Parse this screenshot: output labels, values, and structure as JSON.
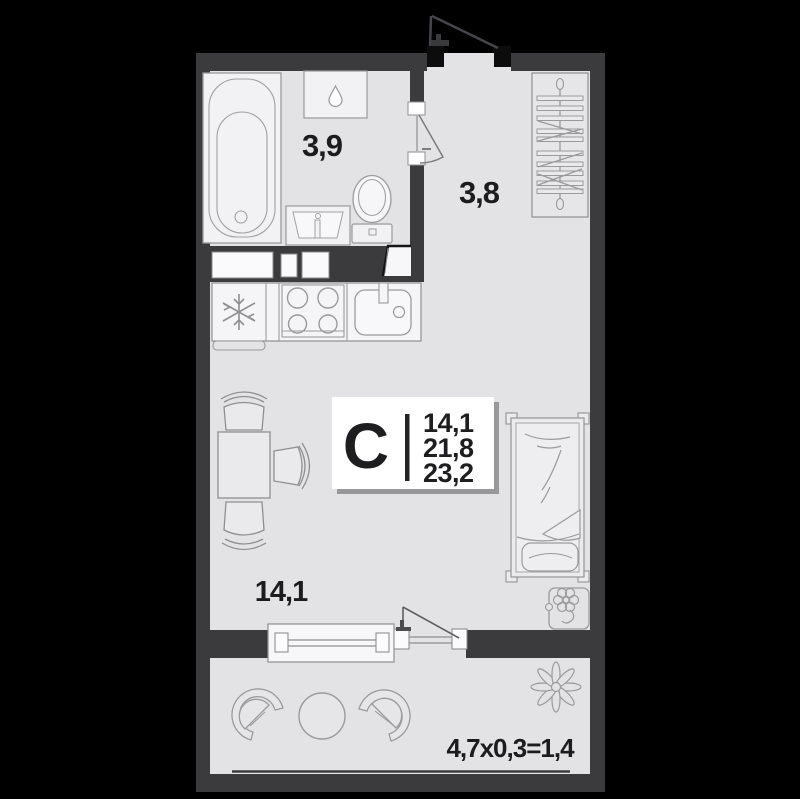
{
  "plan": {
    "type_card": {
      "letter": "С",
      "areas": [
        "14,1",
        "21,8",
        "23,2"
      ]
    },
    "labels": {
      "bathroom": "3,9",
      "hallway": "3,8",
      "living": "14,1",
      "balcony": "4,7x0,3=1,4"
    },
    "colors": {
      "background": "#000000",
      "wall": "#3b3b3d",
      "door_block": "#0c0c0d",
      "floor": "#e3e3e5",
      "fixture_fill": "#f2f2f4",
      "outline": "#9a9a9c",
      "card_bg": "#ffffff",
      "card_shadow": "#98989a",
      "text": "#1c1c1e"
    },
    "icons": [
      "droplet-icon",
      "snowflake-icon",
      "flower-icon",
      "potted-plant-icon"
    ]
  }
}
